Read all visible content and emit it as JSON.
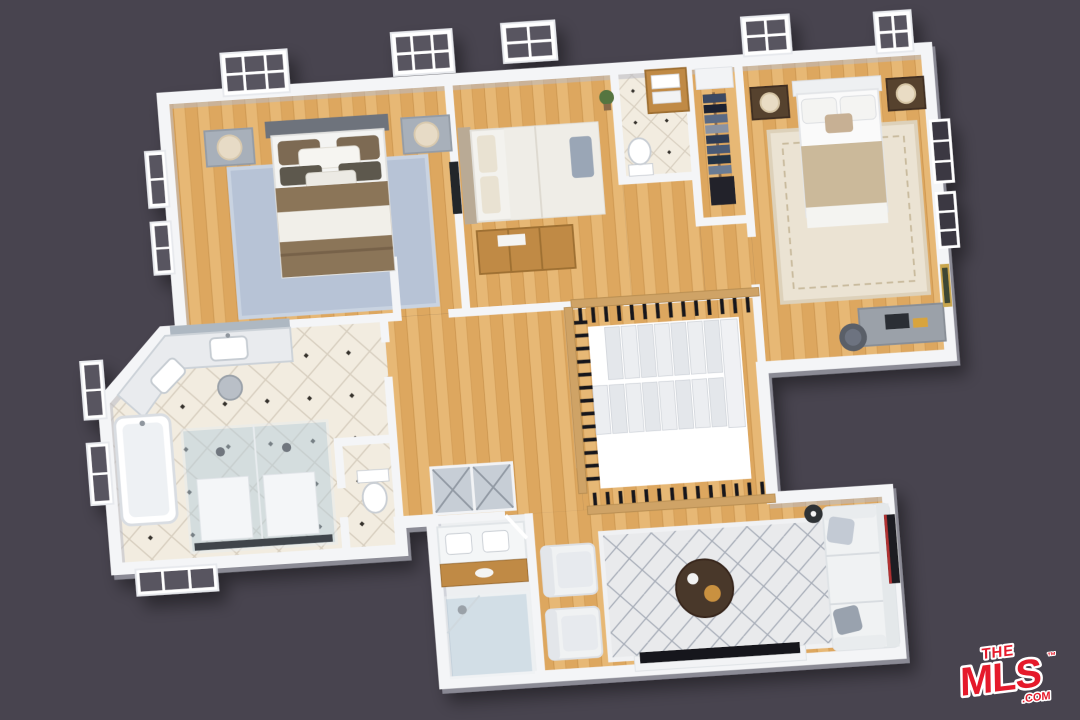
{
  "scene": {
    "type": "3d-floor-plan-rendering",
    "view": "top-down isometric",
    "level": "upper floor"
  },
  "palette": {
    "background": "#48444f",
    "wall": "#f4f5f7",
    "wall_shadow": "#b9bcc6",
    "wood": "#dda75f",
    "wood_light": "#efc684",
    "wood_dark": "#c08а45",
    "wood_line": "#c8914a",
    "tile": "#f2ece0",
    "tile_line": "#d8cfc0",
    "tile_dot": "#35302c",
    "rug_blue": "#b7c3d6",
    "rug_cream": "#ebe3d3",
    "marble": "#e9ebee",
    "glass": "#b8cfdd",
    "railing_wood": "#cfa366",
    "baluster": "#16161a",
    "stair_tread": "#e8eaee",
    "void_white": "#ffffff",
    "sofa_white": "#f0f2f3",
    "bed_brown": "#8b7458",
    "bed_tan": "#cbb99a",
    "table_brown": "#4a3729",
    "logo_red": "#e51a2b"
  },
  "logo": {
    "the": "THE",
    "mls": "MLS",
    "tm": "™",
    "com": ".COM"
  },
  "rooms": [
    {
      "id": "master-bedroom",
      "name": "primary bedroom",
      "floor": "hardwood",
      "furniture": [
        "king-bed",
        "brown-duvet",
        "nightstand-left",
        "nightstand-right",
        "table-lamps",
        "blue-area-rug",
        "windows"
      ]
    },
    {
      "id": "bedroom-2",
      "name": "second bedroom / sitting room",
      "floor": "hardwood",
      "furniture": [
        "bed",
        "wood-dresser",
        "wall-tv",
        "plant"
      ]
    },
    {
      "id": "hall-bathroom",
      "name": "hall bathroom",
      "floor": "diamond-tile",
      "furniture": [
        "wood-vanity",
        "towels",
        "toilet"
      ]
    },
    {
      "id": "walk-in-closet",
      "name": "walk-in closet",
      "floor": "hardwood",
      "furniture": [
        "clothes-rack",
        "garment-bag",
        "shelf"
      ]
    },
    {
      "id": "bedroom-3",
      "name": "third bedroom",
      "floor": "hardwood",
      "furniture": [
        "bed",
        "tan-duvet",
        "nightstands",
        "table-lamps",
        "cream-area-rug",
        "desk",
        "office-chair",
        "wall-art"
      ]
    },
    {
      "id": "master-bathroom",
      "name": "primary bathroom",
      "floor": "diamond-tile",
      "furniture": [
        "marble-vanity",
        "mirror",
        "stool",
        "bathtub",
        "double-glass-shower",
        "toilet-room"
      ]
    },
    {
      "id": "hallway",
      "name": "hallway",
      "floor": "hardwood",
      "furniture": [
        "mirrored-closet"
      ]
    },
    {
      "id": "staircase",
      "name": "staircase",
      "floor": "hardwood",
      "furniture": [
        "u-shaped-stairs",
        "wood-rail-black-balusters",
        "open-void"
      ]
    },
    {
      "id": "loft",
      "name": "loft family room",
      "floor": "hardwood",
      "furniture": [
        "sofa",
        "two-armchairs",
        "round-coffee-table",
        "geometric-rug",
        "media-console",
        "wall-tv"
      ]
    },
    {
      "id": "lower-bathroom",
      "name": "lower bathroom",
      "floor": "tile",
      "furniture": [
        "double-sink-vanity",
        "wood-shelf",
        "glass-shower"
      ]
    }
  ]
}
